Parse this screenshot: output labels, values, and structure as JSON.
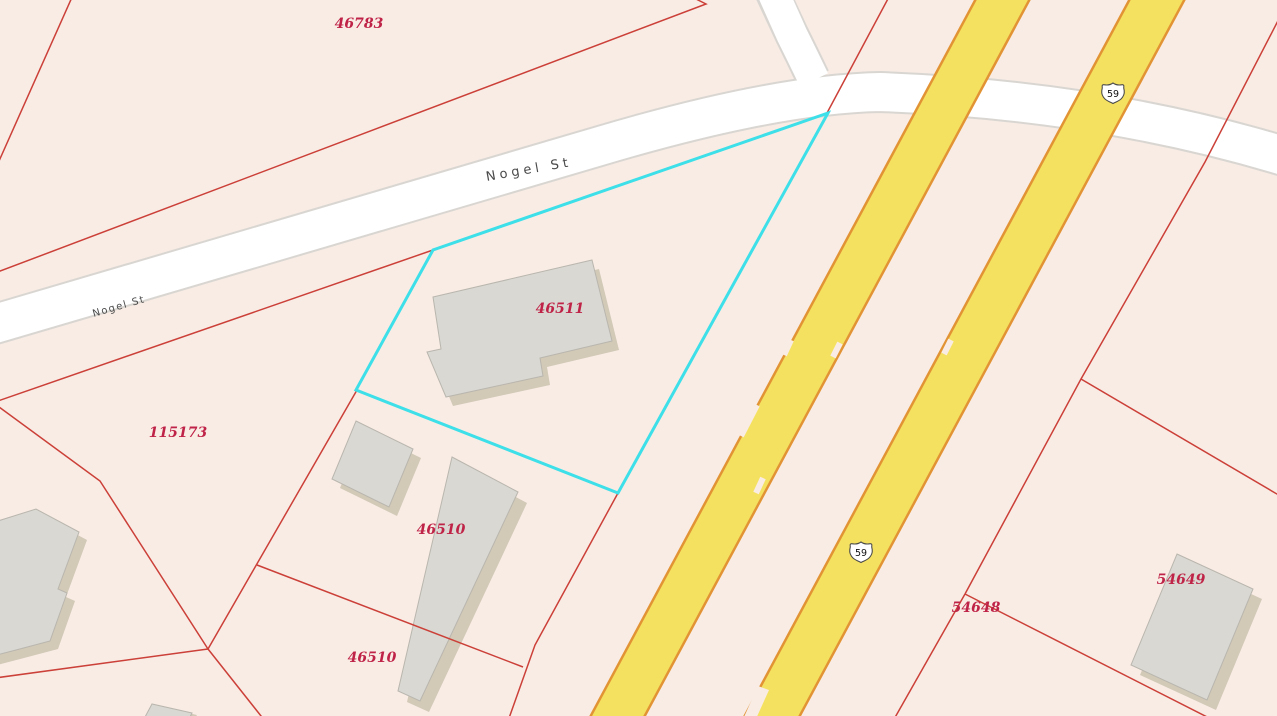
{
  "street": {
    "name": "Nogel St"
  },
  "highway": {
    "route": "59"
  },
  "parcels": [
    {
      "label": "46783"
    },
    {
      "label": "46511"
    },
    {
      "label": "115173"
    },
    {
      "label": "46510"
    },
    {
      "label": "46510"
    },
    {
      "label": "54648"
    },
    {
      "label": "54649"
    }
  ],
  "colors": {
    "background": "#f9ece5",
    "parcel_line": "#cb4038",
    "parcel_label": "#bf2347",
    "road_fill": "#ffffff",
    "road_casing": "#d9d6d2",
    "highway_fill": "#f5e160",
    "highway_casing": "#e29435",
    "building_fill": "#d9d8d2",
    "building_shadow": "#d2c9b7",
    "selection_highlight": "#3ddfe8",
    "street_label": "#4a4a4a"
  }
}
